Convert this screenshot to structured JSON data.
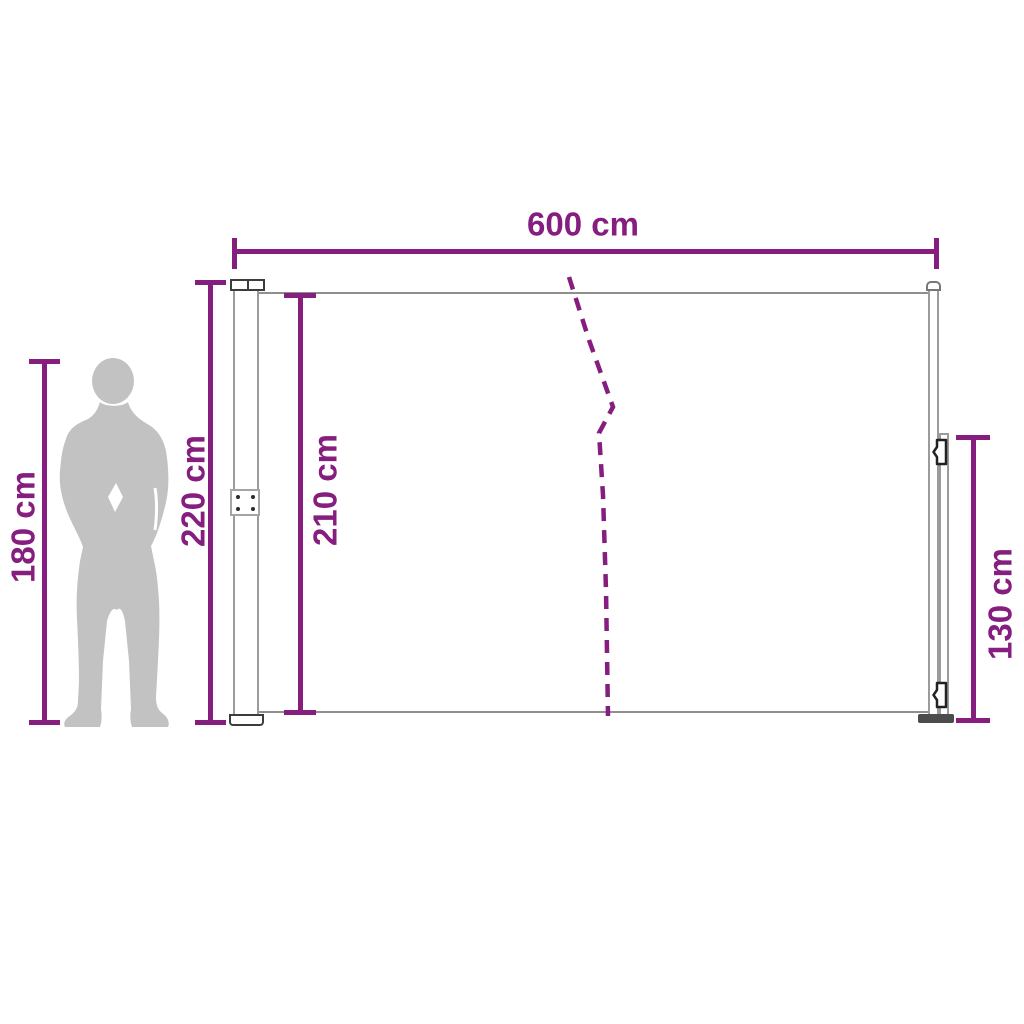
{
  "diagram": {
    "type": "product-dimension-diagram",
    "subject": "retractable side awning with support pole and human figure for scale",
    "unit": "cm",
    "measurements": {
      "width": {
        "value": 600,
        "unit": "cm",
        "label": "600 cm",
        "refers_to": "total awning width"
      },
      "cassette_height": {
        "value": 220,
        "unit": "cm",
        "label": "220 cm",
        "refers_to": "cassette post height"
      },
      "fabric_height": {
        "value": 210,
        "unit": "cm",
        "label": "210 cm",
        "refers_to": "fabric panel height"
      },
      "person_height": {
        "value": 180,
        "unit": "cm",
        "label": "180 cm",
        "refers_to": "human silhouette height"
      },
      "pull_bar_height": {
        "value": 130,
        "unit": "cm",
        "label": "130 cm",
        "refers_to": "pull handle bar height"
      }
    },
    "colors": {
      "dimension_accent": "#851e7e",
      "silhouette_gray": "#c2c2c2",
      "outline_gray": "#9b9b9b",
      "edge_gray": "#8f8f8f",
      "detail_dark": "#3c3c3c",
      "background": "#ffffff"
    }
  }
}
